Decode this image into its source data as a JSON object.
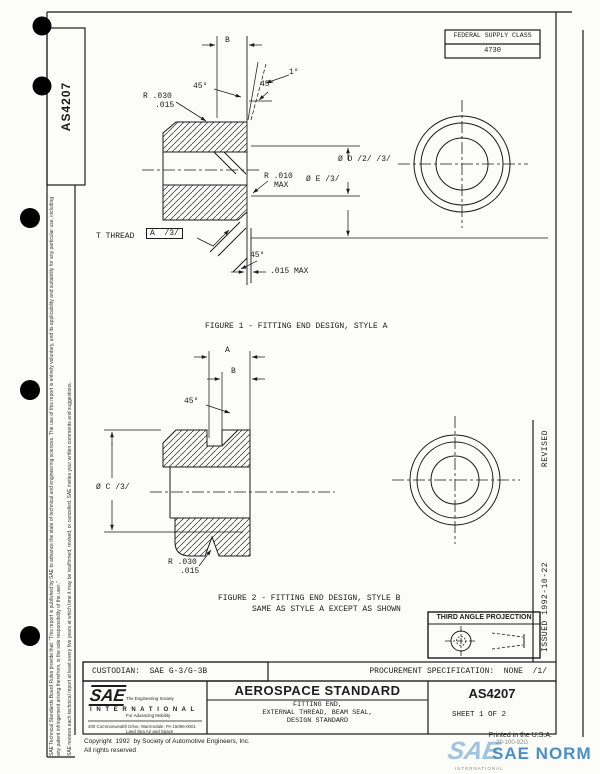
{
  "document": {
    "number_vertical": "AS4207",
    "issued": "ISSUED  1992-10-22",
    "revised": "REVISED",
    "federal_supply_class_label": "FEDERAL SUPPLY CLASS",
    "federal_supply_class_value": "4730",
    "disclaimer_1": "SAE Technical Standards Board Rules provide that: \"This report is published by SAE to advance the state of technical and engineering sciences. The use of this report is entirely voluntary, and its applicability and suitability for any particular use, including any patent infringement arising therefrom, is the sole responsibility of the user.\"",
    "disclaimer_2": "SAE reviews each technical report at least every five years at which time it may be reaffirmed, revised, or cancelled. SAE invites your written comments and suggestions."
  },
  "figure1": {
    "caption": "FIGURE 1 - FITTING END DESIGN, STYLE A",
    "labels": {
      "dim_b": "B",
      "angle_45_top": "45°",
      "angle_1": "1°",
      "angle_45_chamfer": "45°",
      "radius_030_line1": "R .030",
      "radius_030_line2": ".015",
      "dia_d": "Ø D /2/ /3/",
      "dia_e": "Ø E /3/",
      "radius_010_line1": "R .010",
      "radius_010_line2": "MAX",
      "thread": "T THREAD",
      "thread_datum": "A  /3/",
      "angle_45_bottom": "45°",
      "gap_015": ".015 MAX"
    }
  },
  "figure2": {
    "caption_line1": "FIGURE 2 - FITTING END DESIGN, STYLE B",
    "caption_line2": "SAME AS STYLE A EXCEPT AS SHOWN",
    "labels": {
      "dim_a": "A",
      "dim_b": "B",
      "angle_45": "45°",
      "dia_c": "Ø C /3/",
      "radius_030_line1": "R .030",
      "radius_030_line2": ".015"
    }
  },
  "projection": {
    "title": "THIRD ANGLE PROJECTION"
  },
  "title_block": {
    "custodian": "CUSTODIAN:  SAE G-3/G-3B",
    "procurement": "PROCUREMENT SPECIFICATION:  NONE  /1/",
    "logo": {
      "sae": "SAE",
      "tagline_1": "The Engineering Society",
      "tagline_2": "For Advancing Mobility",
      "tagline_3": "Land Sea Air and Space",
      "international": "I N T E R N A T I O N A L",
      "address": "400 Commonwealth Drive, Warrendale, PA 15096-0001"
    },
    "standard_type": "AEROSPACE STANDARD",
    "title_line1": "FITTING END,",
    "title_line2": "EXTERNAL THREAD, BEAM SEAL,",
    "title_line3": "DESIGN STANDARD",
    "number": "AS4207",
    "sheet": "SHEET 1 OF 2"
  },
  "footer": {
    "copyright_1": "Copyright  1992  by Society of Automotive Engineers, Inc.",
    "copyright_2": "All rights reserved",
    "printed": "Printed in the U.S.A.",
    "stamp": "20-100-92G",
    "watermark_sae": "SAE",
    "watermark_norm": "SAE NORM",
    "watermark_international": "INTERNATIONAL"
  }
}
